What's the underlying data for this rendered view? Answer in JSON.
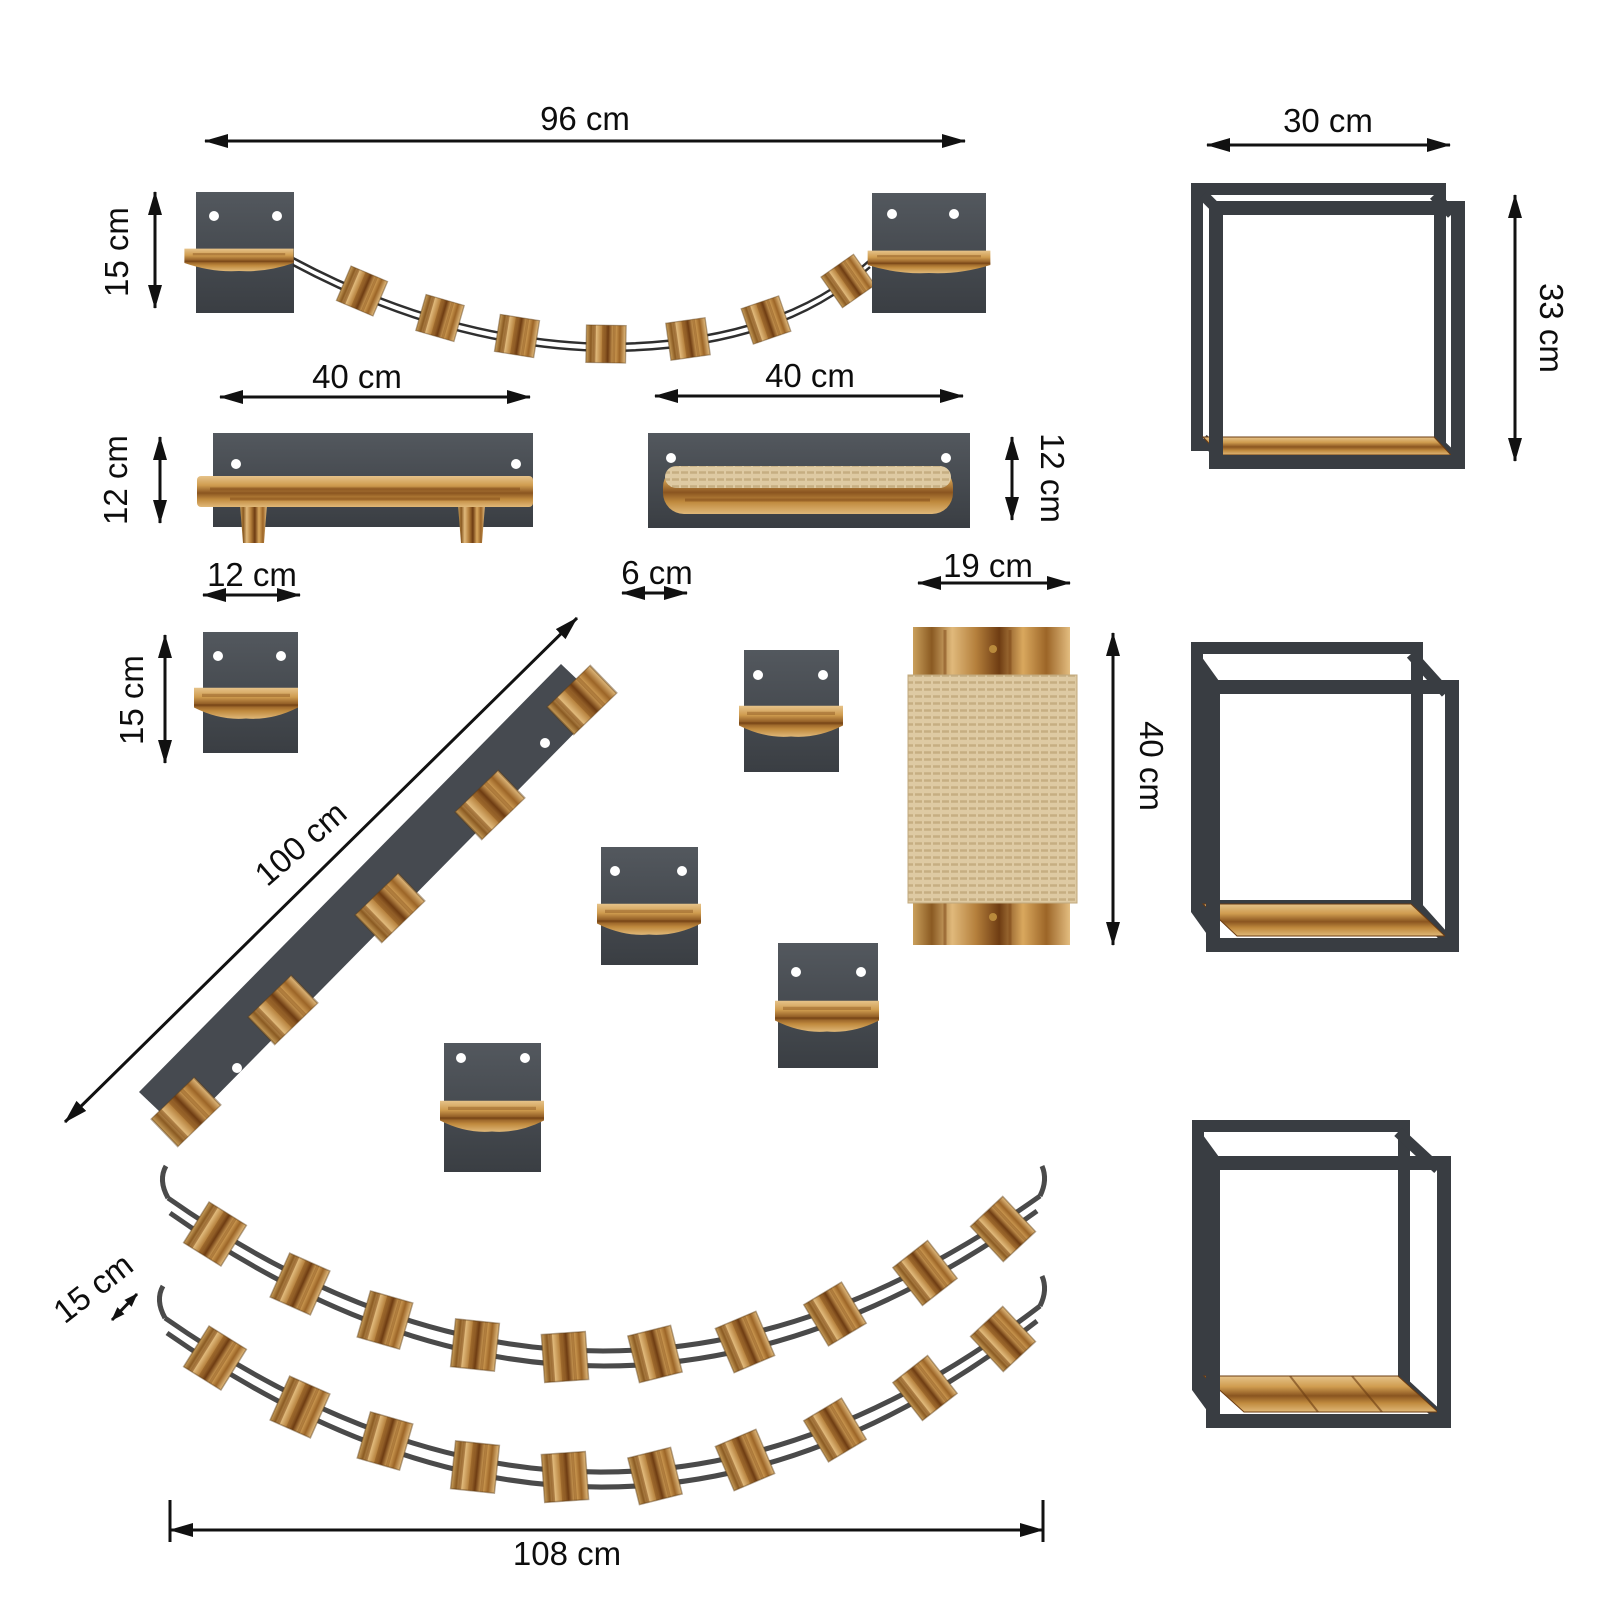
{
  "page": {
    "background": "#ffffff"
  },
  "colors": {
    "panel_dark": "#44484e",
    "panel_dark2": "#393d42",
    "wood_light": "#e6c38a",
    "wood_mid": "#c98f3f",
    "wood_dark": "#7a4416",
    "sisal": "#decaa3",
    "sisal_line": "#c6ae82",
    "rope": "#4a4a4a",
    "dimension": "#111111",
    "hole": "#ffffff",
    "screw": "#b98a3c",
    "bg": "#ffffff"
  },
  "labels": {
    "bridge_width": "96 cm",
    "bridge_bracket_height": "15 cm",
    "cube_width": "30 cm",
    "cube_height": "33 cm",
    "shelf_left_width": "40 cm",
    "shelf_left_height": "12 cm",
    "shelf_cushion_width": "40 cm",
    "shelf_cushion_height": "12 cm",
    "step_width": "12 cm",
    "step_height": "15 cm",
    "ramp_width": "6 cm",
    "ramp_length": "100 cm",
    "scratcher_width": "19 cm",
    "scratcher_height": "40 cm",
    "curved_bridge_depth": "15 cm",
    "curved_bridge_width": "108 cm"
  }
}
